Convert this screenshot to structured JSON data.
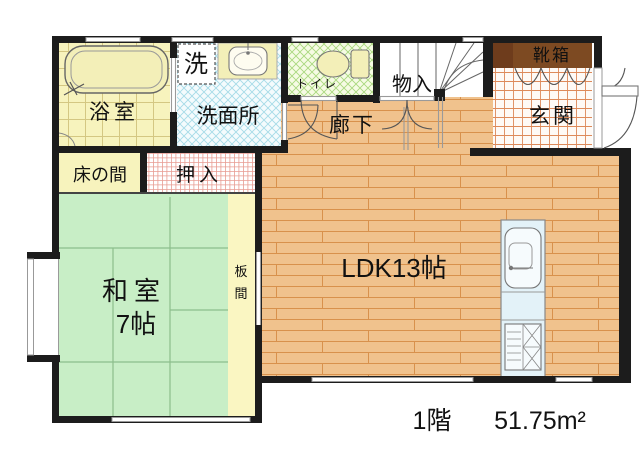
{
  "plan": {
    "floor_label": "1階",
    "area_label": "51.75m²",
    "rooms": {
      "bathroom": "浴室",
      "laundry": "洗",
      "washroom": "洗面所",
      "toilet": "トイレ",
      "storage": "物入",
      "shoe_box": "靴箱",
      "entrance": "玄関",
      "hallway": "廊下",
      "tokonoma": "床の間",
      "closet": "押入",
      "japanese_room": "和室",
      "japanese_room_size": "7帖",
      "wood_strip_chars": [
        "板",
        "間"
      ],
      "ldk": "LDK13帖"
    }
  },
  "colors": {
    "wall": "#1c1c1c",
    "wood_floor": "#f0c28d",
    "wood_line": "#d8914c",
    "tatami": "#c8eec6",
    "tatami_line": "#8cbe8c",
    "bath_tile_bg": "#f7f3bd",
    "bath_tile_line": "#d4c782",
    "washroom_bg": "#f4fbfd",
    "washroom_hatch": "#a5dbe8",
    "toilet_bg": "#f6fbe4",
    "toilet_hatch": "#a9d87e",
    "closet_hatch": "#e89c92",
    "entrance_tile_line": "#dd8a5a",
    "shoe_box": "#7d4a22",
    "tokonoma_bg": "#f7f3bd",
    "itame_bg": "#faf6c2",
    "kitchen_counter": "#e3f2f8",
    "fixture_fill": "#f3efb8",
    "window_line": "#999999",
    "text": "#111111"
  }
}
